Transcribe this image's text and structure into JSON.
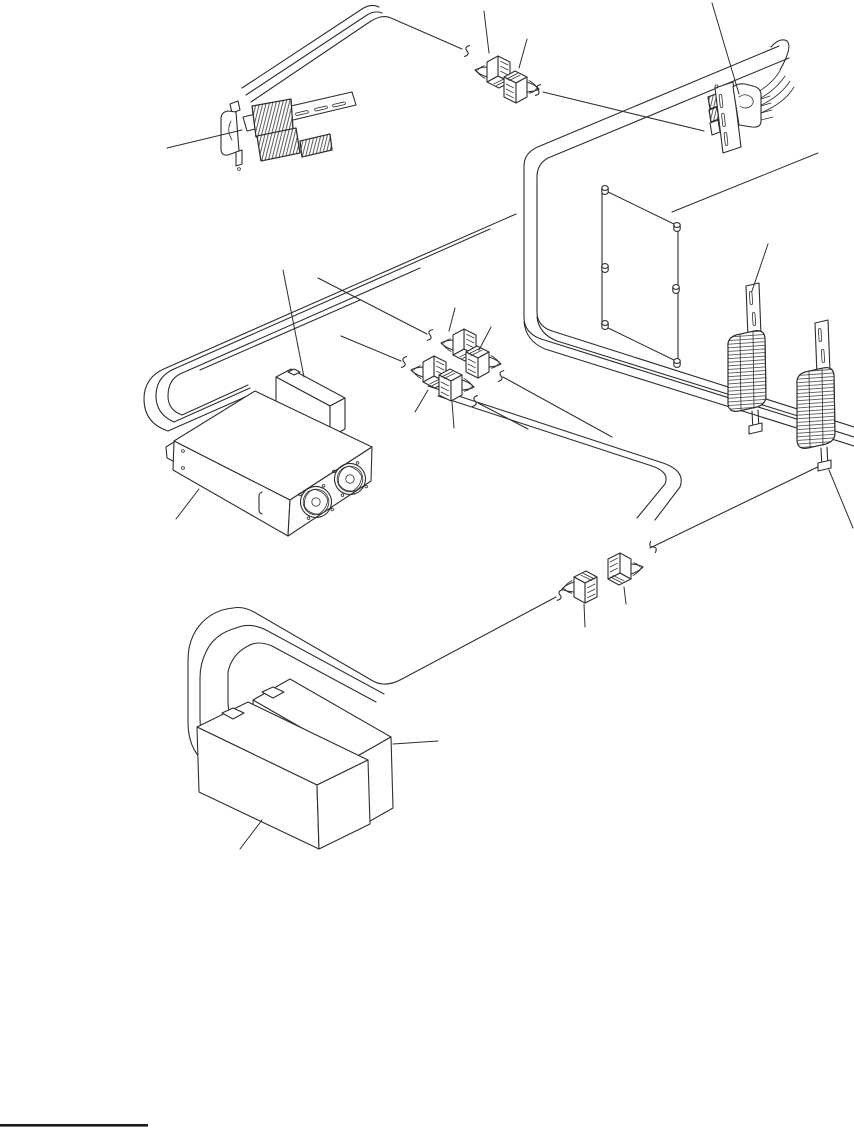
{
  "figure": {
    "kind": "cable-assembly-exploded-diagram",
    "background": "#ffffff",
    "line_color": "#2e2e2e",
    "parts": [
      {
        "id": "cable-bracket-assembly",
        "label": "cable bracket assembly"
      },
      {
        "id": "top-connector-pair",
        "label": "inline connector pair top"
      },
      {
        "id": "io-connector-bracket",
        "label": "io connector bracket"
      },
      {
        "id": "controller-board",
        "label": "controller board"
      },
      {
        "id": "card-edge-connector-left",
        "label": "card edge cable connector left"
      },
      {
        "id": "card-edge-connector-right",
        "label": "card edge cable connector right"
      },
      {
        "id": "middle-connector-pair-upper",
        "label": "inline connector pair middle upper"
      },
      {
        "id": "middle-connector-pair-lower",
        "label": "inline connector pair middle lower"
      },
      {
        "id": "power-supply",
        "label": "power supply"
      },
      {
        "id": "power-supply-cover",
        "label": "power supply cover"
      },
      {
        "id": "bottom-connector-pair",
        "label": "inline connector pair bottom"
      },
      {
        "id": "battery-pack-rear",
        "label": "battery pack rear"
      },
      {
        "id": "battery-pack-front",
        "label": "battery pack front"
      },
      {
        "id": "cable-harness",
        "label": "cable harness loops"
      },
      {
        "id": "leader-lines",
        "label": "callout leader lines"
      },
      {
        "id": "footnote-rule",
        "label": "footnote rule"
      }
    ]
  }
}
